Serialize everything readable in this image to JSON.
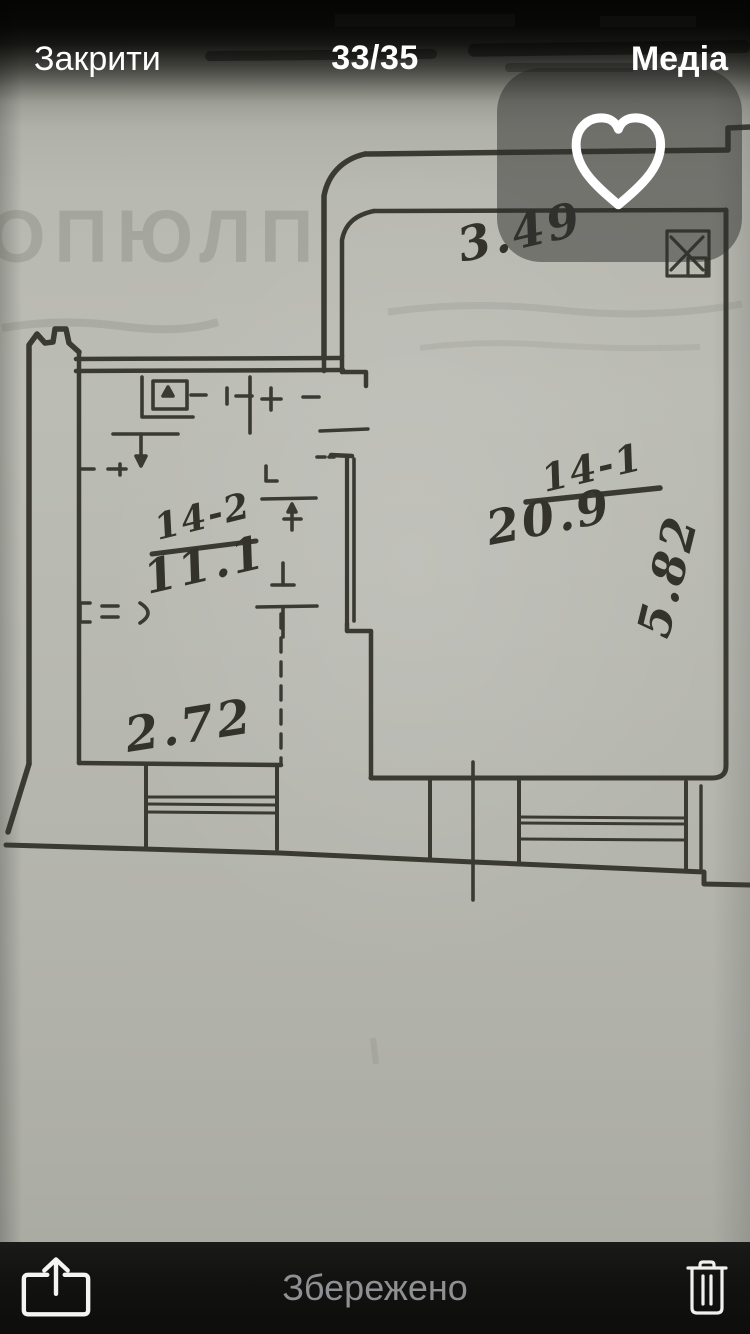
{
  "top_bar": {
    "close_label": "Закрити",
    "counter": "33/35",
    "media_label": "Медіа"
  },
  "overlay": {
    "heart_icon": "heart-outline-icon"
  },
  "floor_plan": {
    "room_right": {
      "code": "14-1",
      "area": "20.9",
      "width": "3.49",
      "depth": "5.82"
    },
    "room_left": {
      "code": "14-2",
      "area": "11.1",
      "width": "2.72"
    },
    "background_marks": "ОПЮЛП",
    "symbols": [
      "window-with-cross-icon",
      "window-sill",
      "door-opening",
      "plumbing-fixtures",
      "dimension-ticks"
    ]
  },
  "bottom_bar": {
    "share_icon": "share-icon",
    "saved_label": "Збережено",
    "trash_icon": "trash-icon"
  },
  "colors": {
    "paper": "#b7b8b0",
    "ink": "#3a3a33",
    "bar_text": "#ffffff",
    "saved_text": "#8f9094",
    "overlay_panel": "rgba(46,46,43,0.5)"
  }
}
